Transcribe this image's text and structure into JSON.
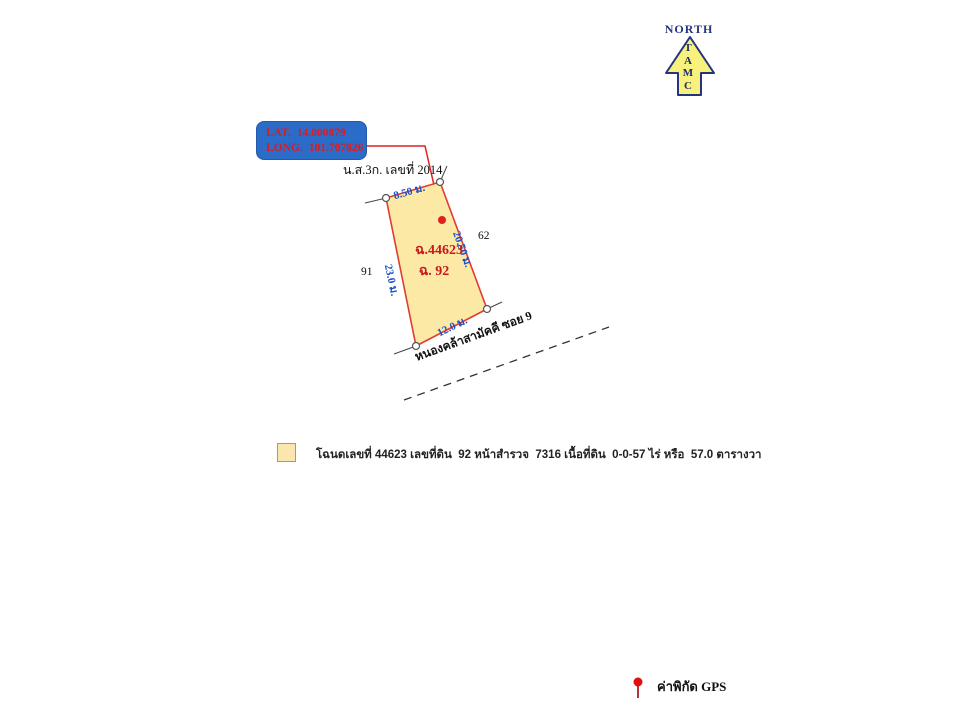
{
  "north": {
    "label": "NORTH",
    "letters": [
      "T",
      "A",
      "M",
      "C"
    ]
  },
  "gps_box": {
    "lat_label": "LAT.",
    "lat_value": "14.000879",
    "long_label": "LONG.",
    "long_value": "101.707826"
  },
  "deed_ref": "น.ส.3ก. เลขที่ 2014",
  "parcel": {
    "deed_no": "ฉ.44623",
    "land_no": "ฉ. 92",
    "sides": {
      "top": "8.50 ม.",
      "right": "20.50 ม.",
      "left": "23.0 ม.",
      "bottom": "12.0 ม."
    },
    "neighbors": {
      "right": "62",
      "left": "91"
    },
    "area_text": "0-0-57 ไร่ หรือ 57.0 ตารางวา"
  },
  "road": {
    "name": "หนองคล้าสามัคคี ซอย 9"
  },
  "legend": {
    "text": "โฉนดเลขที่ 44623 เลขที่ดิน  92 หน้าสำรวจ  7316 เนื้อที่ดิน  0-0-57 ไร่ หรือ  57.0 ตารางวา"
  },
  "gps_legend": {
    "label": "ค่าพิกัด GPS"
  },
  "colors": {
    "parcel_fill": "#FCE9A6",
    "parcel_stroke": "#E03C31",
    "box_fill": "#2B6CC8",
    "box_text": "#E01920",
    "dimension_text": "#1E4FC8",
    "navy": "#24357E",
    "arrow_fill": "#F8F17C",
    "pin_red": "#E01010",
    "legend_swatch_fill": "#FBE7AE",
    "legend_swatch_border": "#E0806C"
  }
}
